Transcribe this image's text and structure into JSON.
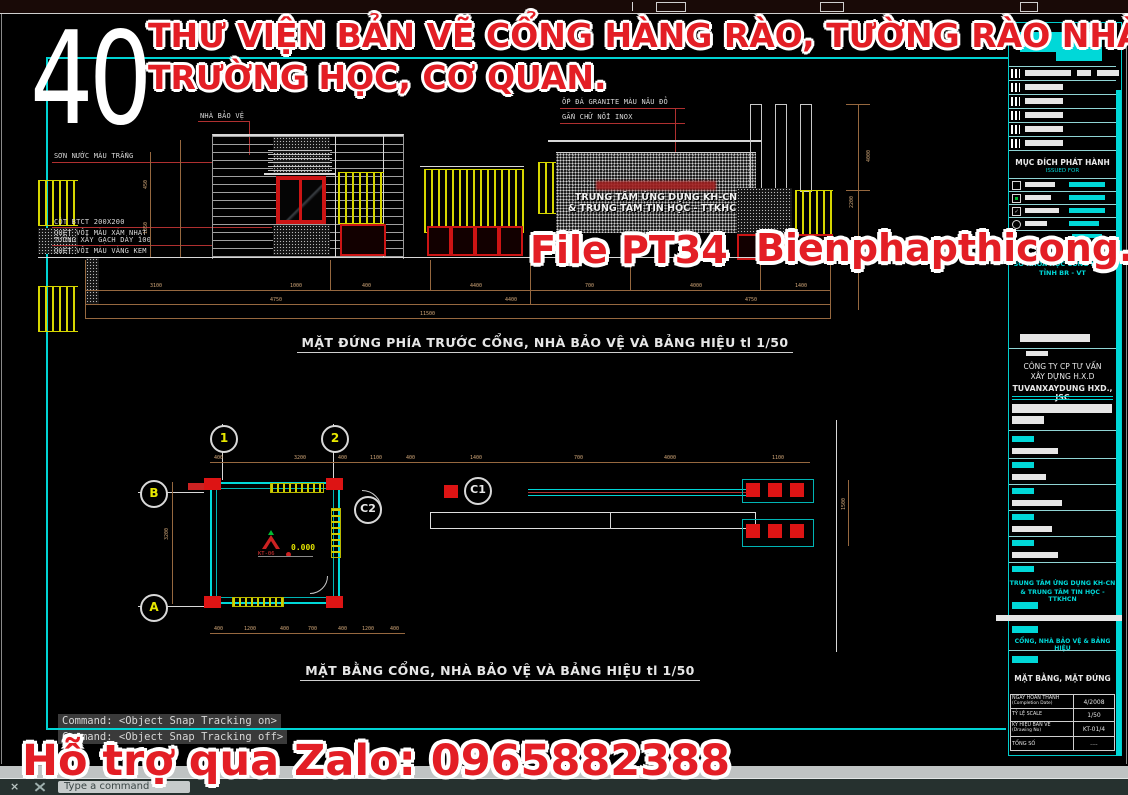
{
  "overlay": {
    "big_number": "40",
    "title_line1": "THƯ VIỆN BẢN VẼ CỔNG HÀNG RÀO, TƯỜNG RÀO NHÀ Ở",
    "title_line2": "TRƯỜNG HỌC, CƠ QUAN.",
    "file_label": "File PT34",
    "website": "Bienphapthicong.vn",
    "zalo": "Hỗ trợ qua Zalo: 0965882388",
    "red": "#e31e25"
  },
  "elevation": {
    "caption": "MẶT ĐỨNG PHÍA TRƯỚC CỔNG, NHÀ BẢO VỆ VÀ BẢNG HIỆU tl 1/50",
    "label_guard_house": "NHÀ BẢO VỆ",
    "label_paint": "SƠN NƯỚC MÀU TRẮNG",
    "label_column_1": "CỘT BTCT 200X200",
    "label_column_2": "QUÉT VÔI MÀU XÁM NHẠT",
    "label_wall_1": "TƯỜNG XÂY GẠCH DÀY 100",
    "label_wall_2": "QUÉT VÔI MÀU VÀNG KEM",
    "label_granite": "ỐP ĐÁ GRANITE MÀU NÂU ĐỎ",
    "label_inox": "GẮN CHỮ NỔI INOX",
    "sign_line1": "TRUNG TÂM ỨNG DỤNG KH-CN",
    "sign_line2": "& TRUNG TÂM TIN HỌC - TTKHCN",
    "dims_row1": [
      "3100",
      "1000",
      "400",
      "4400",
      "700",
      "4000",
      "1400"
    ],
    "dims_row2": [
      "4750",
      "4400",
      "4750"
    ],
    "dim_total": "11500",
    "dim_v1": "2200",
    "dim_v2": "4000",
    "dim_l1": "450",
    "dim_l2": "1350"
  },
  "plan": {
    "caption": "MẶT BẰNG CỔNG, NHÀ BẢO VỆ VÀ BẢNG HIỆU tl 1/50",
    "grid_1": "1",
    "grid_2": "2",
    "grid_B": "B",
    "grid_A": "A",
    "door_c1": "C1",
    "door_c2": "C2",
    "level_value": "0.000",
    "level_ref": "KT-06",
    "dims_top": [
      "400",
      "3200",
      "400",
      "1100",
      "400",
      "1400",
      "700",
      "4000",
      "1100"
    ],
    "dims_bottom": [
      "400",
      "1200",
      "400",
      "700",
      "400",
      "1200",
      "400"
    ],
    "dim_left": "3200",
    "dim_right": "1500"
  },
  "titleblock": {
    "header_fragment": "Ủ",
    "issue_title": "MỤC ĐÍCH PHÁT HÀNH",
    "issue_sub": "ISSUED FOR",
    "agency_1": "SỞ KHOA HỌC CÔNG NGHỆ",
    "agency_2": "TỈNH BR - VT",
    "company_1": "CÔNG TY CP TƯ VẤN",
    "company_2": "XÂY DỰNG H.X.D",
    "company_en": "TUVANXAYDUNG HXD., JSC",
    "project_1": "TRUNG TÂM ỨNG DỤNG KH-CN",
    "project_2": "& TRUNG TÂM TIN HỌC - TTKHCN",
    "item_name": "CỔNG, NHÀ BẢO VỆ & BẢNG HIỆU",
    "sheet_name": "MẶT BẰNG, MẶT ĐỨNG",
    "check2": "✓",
    "table": {
      "r1_label": "NGÀY HOÀN THÀNH",
      "r1_sub": "(Completion Date)",
      "r1_value": "4/2008",
      "r2_label": "TỶ LỆ SCALE",
      "r2_value": "1/50",
      "r3_label": "KÝ HIỆU BẢN VẼ",
      "r3_sub": "(Drawing No)",
      "r3_value": "KT-01/4",
      "r4_label": "TỔNG SỐ",
      "r4_value": "...."
    }
  },
  "command": {
    "line1": "Command:  <Object Snap Tracking on>",
    "line2": "Command:  <Object Snap Tracking off>",
    "prompt": "Type a command",
    "close": "×"
  }
}
